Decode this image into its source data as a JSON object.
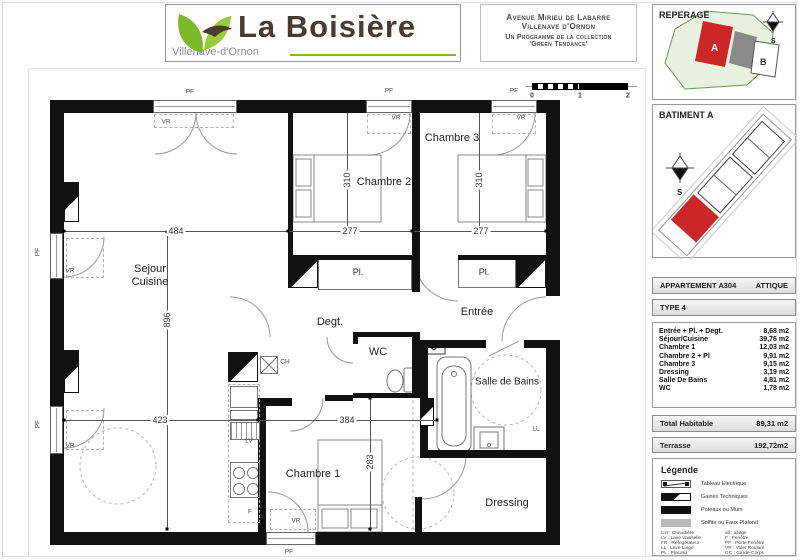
{
  "header": {
    "logo_title": "La Boisière",
    "logo_subtitle": "Villenave-d'Ornon",
    "address_line1": "Avenue Mirieu de Labarre",
    "address_line2": "Villenave d'Ornon",
    "address_line3": "Un Programme de la collection",
    "address_line4": "'Green Tendance'"
  },
  "scale_bar": {
    "t0": "0",
    "t1": "1",
    "t2": "2"
  },
  "sidebar": {
    "reperage_title": "REPERAGE",
    "batiment_title": "BATIMENT A",
    "compass_s": "S",
    "map_label_a": "A",
    "map_label_b": "B",
    "apartment_label": "APPARTEMENT A304",
    "apartment_level": "ATTIQUE",
    "type_label": "TYPE 4",
    "rooms": [
      {
        "name": "Entrée + Pl. + Degt.",
        "area": "8,68 m2"
      },
      {
        "name": "Séjour/Cuisine",
        "area": "39,76 m2"
      },
      {
        "name": "Chambre 1",
        "area": "12,03 m2"
      },
      {
        "name": "Chambre 2 + Pl",
        "area": "9,91 m2"
      },
      {
        "name": "Chambre 3",
        "area": "9,15 m2"
      },
      {
        "name": "Dressing",
        "area": "3,19 m2"
      },
      {
        "name": "Salle De Bains",
        "area": "4,81 m2"
      },
      {
        "name": "WC",
        "area": "1,78 m2"
      }
    ],
    "total_label": "Total Habitable",
    "total_value": "89,31 m2",
    "terrasse_label": "Terrasse",
    "terrasse_value": "192,72m2",
    "legende_title": "Légende",
    "legend_items": [
      "Tableau Electrique",
      "Gaines Techniques",
      "Poteaux ou Murs",
      "Soffite ou Faux Plafond"
    ],
    "abbr_left": [
      "CH : Chaudière",
      "LV : Lave Vaisselle",
      "FR : Réfrigérateur",
      "LL : Lave Linge",
      "PL : Placard"
    ],
    "abbr_right": [
      "all : allège",
      "F : Fenêtre",
      "PF : Porte Fenêtre",
      "VR : Volet Roulant",
      "GC : Garde-Corps"
    ]
  },
  "plan": {
    "rooms": {
      "sejour": "Sejour",
      "cuisine": "Cuisine",
      "chambre1": "Chambre 1",
      "chambre2": "Chambre 2",
      "chambre3": "Chambre 3",
      "degt": "Degt.",
      "entree": "Entrée",
      "wc": "WC",
      "salle_de_bains": "Salle de Bains",
      "dressing": "Dressing",
      "pl": "Pl."
    },
    "dims": {
      "d484": "484",
      "d277": "277",
      "d310": "310",
      "d896": "896",
      "d423": "423",
      "d384": "384",
      "d283": "283"
    },
    "tags": {
      "pf": "PF",
      "vr": "VR",
      "lv": "LV",
      "ll": "LL",
      "ch": "CH",
      "f": "F"
    }
  },
  "colors": {
    "accent_green": "#7cb928",
    "logo_brown": "#4a3b2e",
    "building_red": "#cc2626"
  }
}
